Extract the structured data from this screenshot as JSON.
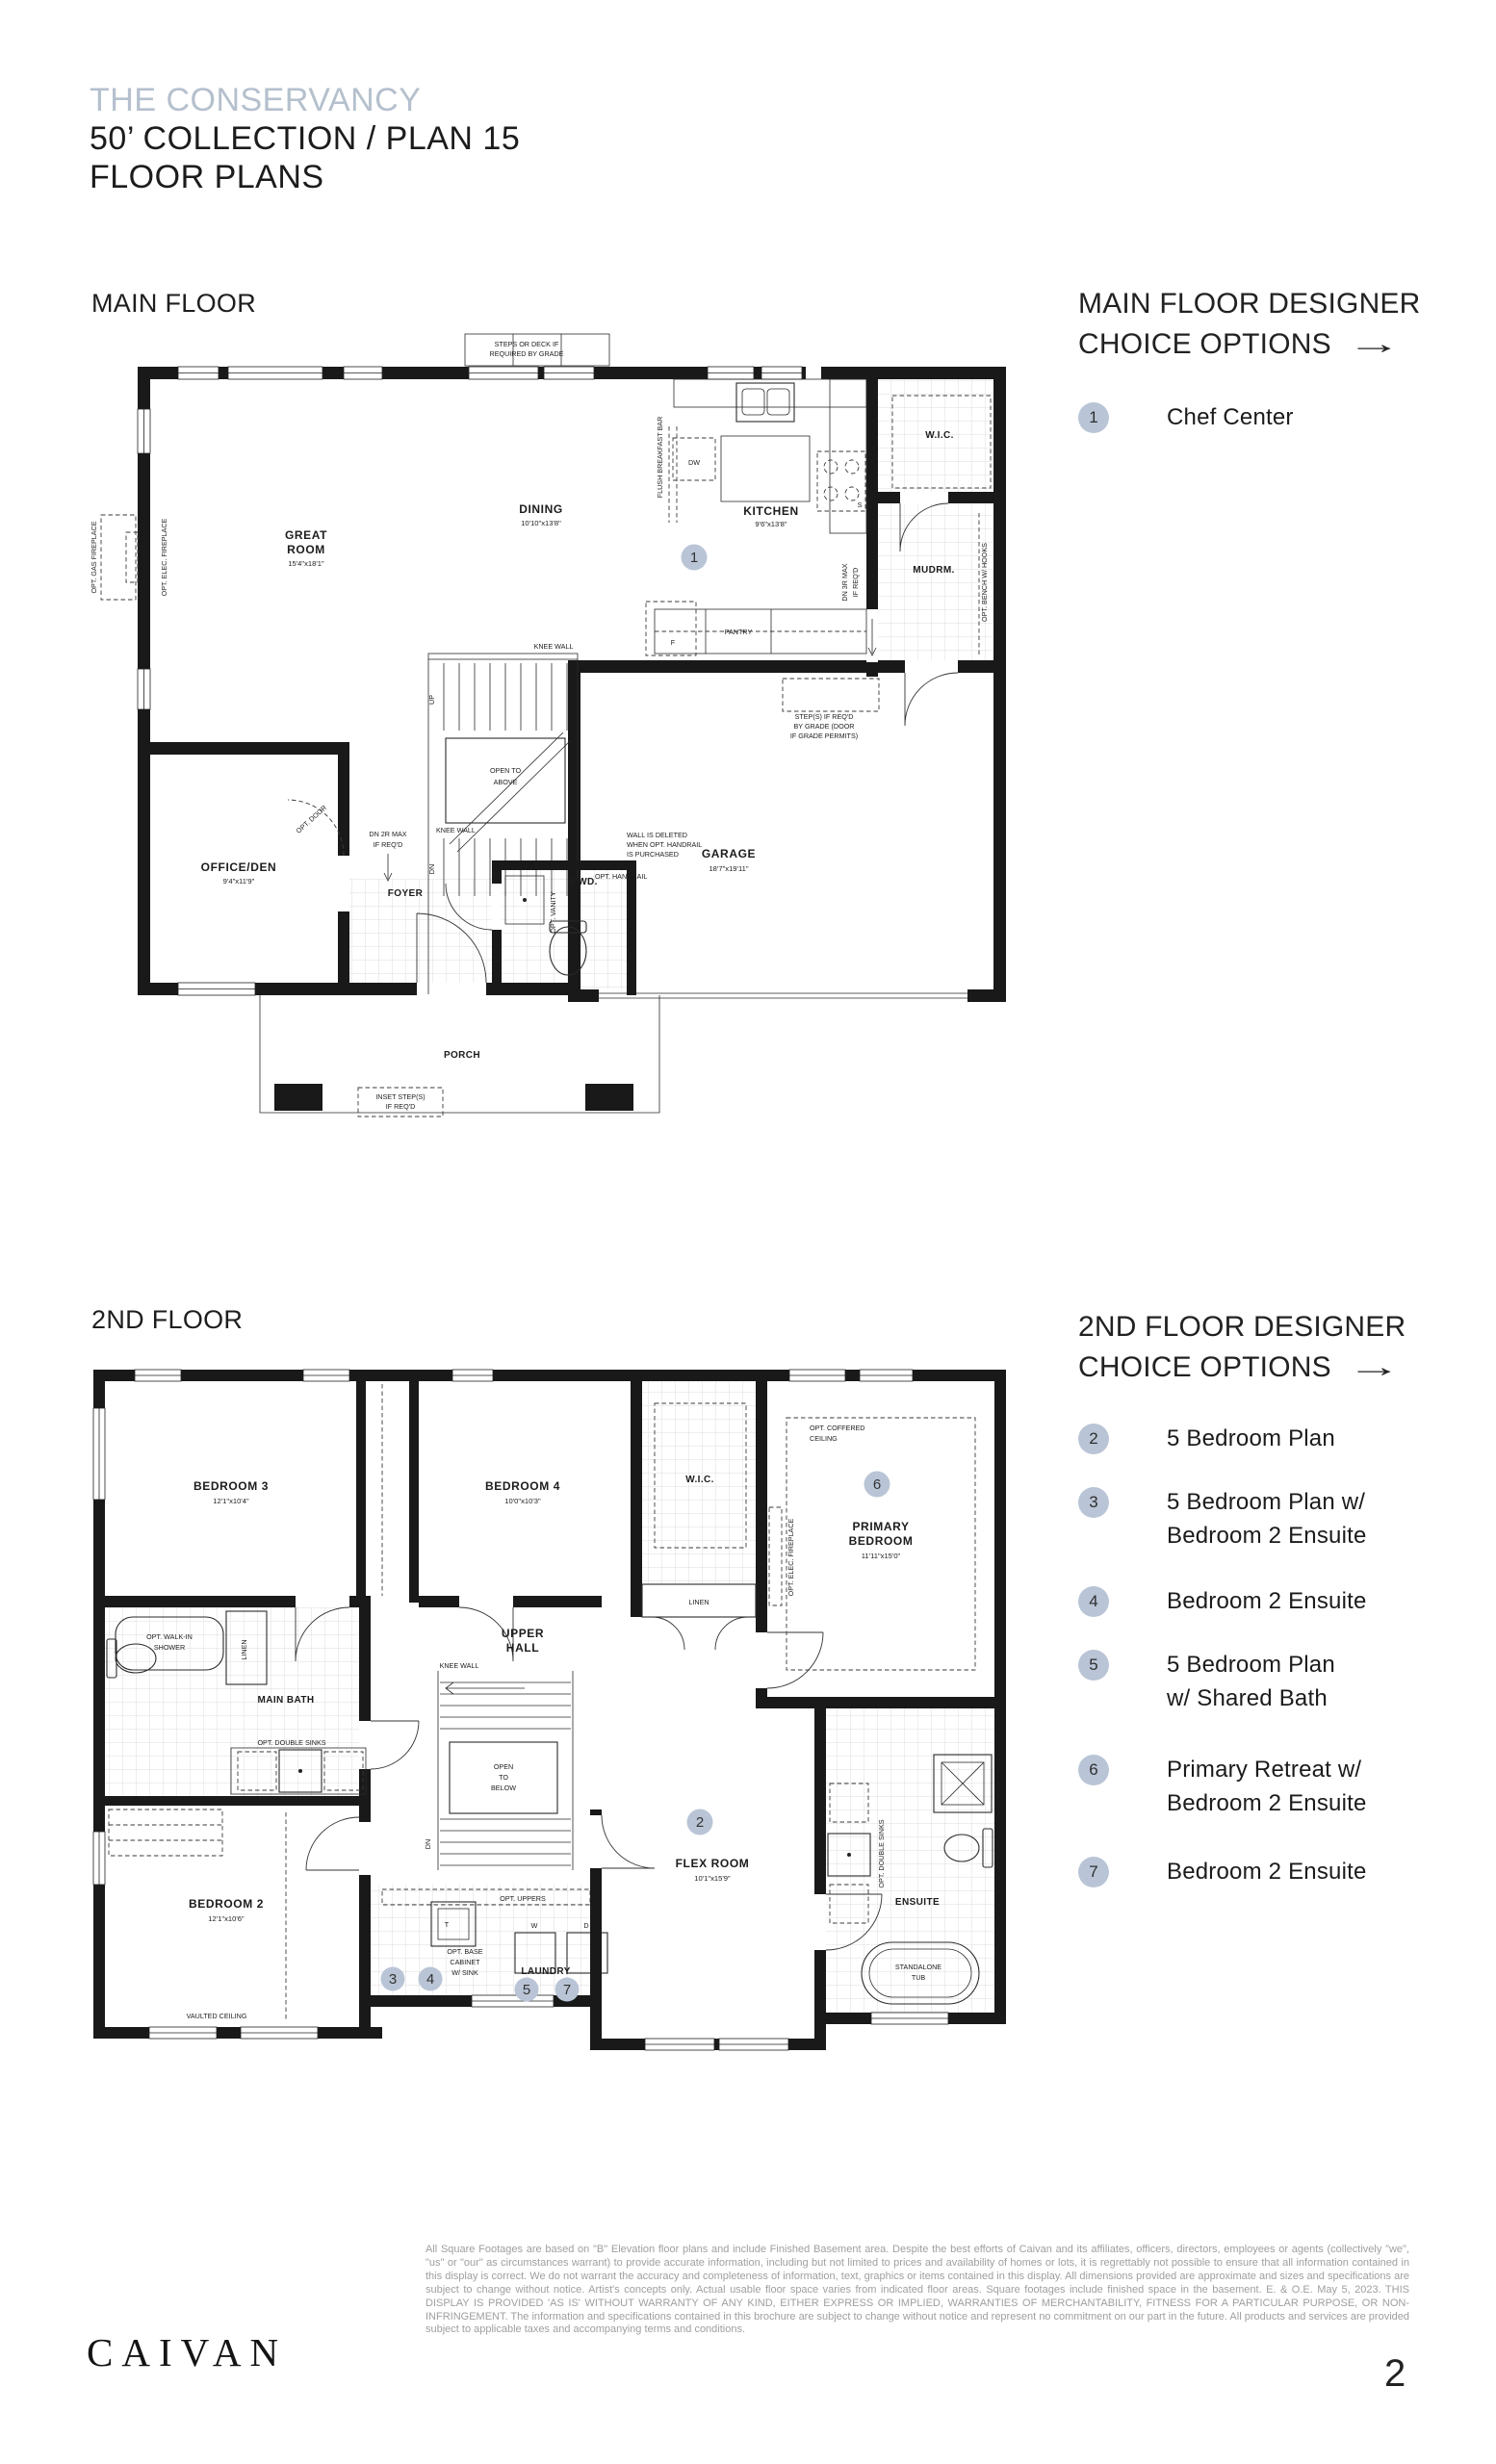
{
  "colors": {
    "badge_accent": "#b9c5d6",
    "title_accent": "#b5c0cd",
    "ink": "#1c1c1c",
    "legal_gray": "#9f9f9f"
  },
  "page": {
    "community": "THE CONSERVANCY",
    "title": "50’ COLLECTION / PLAN 15",
    "subtitle": "FLOOR PLANS",
    "page_number": "2",
    "brand": "CAIVAN",
    "legal": "All Square Footages are based on \"B\" Elevation floor plans and include Finished Basement area. Despite the best efforts of Caivan and its affiliates, officers, directors, employees or agents (collectively \"we\", \"us\" or \"our\" as circumstances warrant) to provide accurate information, including but not limited to prices and availability of homes or lots, it is regrettably not possible to ensure that all information contained in this display is correct. We do not warrant the accuracy and completeness of information, text, graphics or items contained in this display. All dimensions provided are approximate and sizes and specifications are subject to change without notice. Artist's concepts only. Actual usable floor space varies from indicated floor areas. Square footages include finished space in the basement. E. & O.E. May 5, 2023. THIS DISPLAY IS PROVIDED 'AS IS' WITHOUT WARRANTY OF ANY KIND, EITHER EXPRESS OR IMPLIED, WARRANTIES OF MERCHANTABILITY, FITNESS FOR A PARTICULAR PURPOSE, OR NON-INFRINGEMENT. The information and specifications contained in this brochure are subject to change without notice and represent no commitment on our part in the future. All products and services are provided subject to applicable taxes and accompanying terms and conditions."
  },
  "main_floor": {
    "heading": "MAIN FLOOR",
    "options_heading_line1": "MAIN FLOOR DESIGNER",
    "options_heading_line2": "CHOICE OPTIONS",
    "arrow": "→",
    "options": [
      {
        "num": "1",
        "lines": [
          "Chef Center"
        ]
      }
    ],
    "badge": "1",
    "labels": {
      "steps_note_1": "STEPS OR DECK IF",
      "steps_note_2": "REQUIRED BY GRADE",
      "great_room_1": "GREAT",
      "great_room_2": "ROOM",
      "great_room_dims": "15'4\"x18'1\"",
      "dining": "DINING",
      "dining_dims": "10'10\"x13'8\"",
      "flush_bar": "FLUSH BREAKFAST BAR",
      "kitchen": "KITCHEN",
      "kitchen_dims": "9'6\"x13'8\"",
      "dw": "DW",
      "s": "S",
      "f": "F",
      "pantry": "PANTRY",
      "wic": "W.I.C.",
      "mudrm": "MUDRM.",
      "bench": "OPT. BENCH W/ HOOKS",
      "dn3r_1": "DN 3R MAX",
      "dn3r_2": "IF REQ'D",
      "knee_wall_a": "KNEE WALL",
      "knee_wall_b": "KNEE WALL",
      "wall_del_1": "WALL IS DELETED",
      "wall_del_2": "WHEN OPT. HANDRAIL",
      "wall_del_3": "IS PURCHASED",
      "opt_handrail": "OPT. HANDRAIL",
      "up": "UP",
      "dn": "DN",
      "open_above_1": "OPEN TO",
      "open_above_2": "ABOVE",
      "dn2r_1": "DN 2R MAX",
      "dn2r_2": "IF REQ'D",
      "steps_grade_1": "STEP(S) IF REQ'D",
      "steps_grade_2": "BY GRADE (DOOR",
      "steps_grade_3": "IF GRADE PERMITS)",
      "garage": "GARAGE",
      "garage_dims": "18'7\"x19'11\"",
      "office": "OFFICE/DEN",
      "office_dims": "9'4\"x11'9\"",
      "foyer": "FOYER",
      "pwd": "PWD.",
      "opt_vanity": "OPT. VANITY",
      "opt_door": "OPT. DOOR",
      "porch": "PORCH",
      "inset_1": "INSET STEP(S)",
      "inset_2": "IF REQ'D",
      "gas_fp": "OPT. GAS FIREPLACE",
      "elec_fp": "OPT. ELEC. FIREPLACE"
    }
  },
  "second_floor": {
    "heading": "2ND FLOOR",
    "options_heading_line1": "2ND FLOOR DESIGNER",
    "options_heading_line2": "CHOICE OPTIONS",
    "arrow": "→",
    "options": [
      {
        "num": "2",
        "lines": [
          "5 Bedroom Plan"
        ]
      },
      {
        "num": "3",
        "lines": [
          "5 Bedroom Plan w/",
          "Bedroom 2 Ensuite"
        ]
      },
      {
        "num": "4",
        "lines": [
          "Bedroom 2 Ensuite"
        ]
      },
      {
        "num": "5",
        "lines": [
          "5 Bedroom Plan",
          "w/ Shared Bath"
        ]
      },
      {
        "num": "6",
        "lines": [
          "Primary Retreat w/",
          "Bedroom 2 Ensuite"
        ]
      },
      {
        "num": "7",
        "lines": [
          "Bedroom 2 Ensuite"
        ]
      }
    ],
    "badges": {
      "b2": "2",
      "b3": "3",
      "b4": "4",
      "b5": "5",
      "b6": "6",
      "b7": "7"
    },
    "labels": {
      "bedroom3": "BEDROOM 3",
      "bedroom3_dims": "12'1\"x10'4\"",
      "bedroom4": "BEDROOM 4",
      "bedroom4_dims": "10'0\"x10'3\"",
      "wic": "W.I.C.",
      "linen_h": "LINEN",
      "coffered_1": "OPT. COFFERED",
      "coffered_2": "CEILING",
      "primary_1": "PRIMARY",
      "primary_2": "BEDROOM",
      "primary_dims": "11'11\"x15'0\"",
      "elec_fp": "OPT. ELEC. FIREPLACE",
      "walkin_1": "OPT. WALK-IN",
      "walkin_2": "SHOWER",
      "linen_v": "LINEN",
      "main_bath": "MAIN BATH",
      "upper_1": "UPPER",
      "upper_2": "HALL",
      "knee_wall": "KNEE WALL",
      "dbl_sinks": "OPT. DOUBLE SINKS",
      "open_below_1": "OPEN",
      "open_below_2": "TO",
      "open_below_3": "BELOW",
      "dn": "DN",
      "bedroom2": "BEDROOM 2",
      "bedroom2_dims": "12'1\"x10'6\"",
      "vaulted": "VAULTED CEILING",
      "flex": "FLEX ROOM",
      "flex_dims": "10'1\"x15'9\"",
      "opt_uppers": "OPT. UPPERS",
      "base_cab_1": "OPT. BASE",
      "base_cab_2": "CABINET",
      "base_cab_3": "W/ SINK",
      "t": "T",
      "w": "W",
      "d": "D",
      "laundry": "LAUNDRY",
      "ensuite": "ENSUITE",
      "dbl_sinks_v": "OPT. DOUBLE SINKS",
      "tub_1": "STANDALONE",
      "tub_2": "TUB"
    }
  }
}
